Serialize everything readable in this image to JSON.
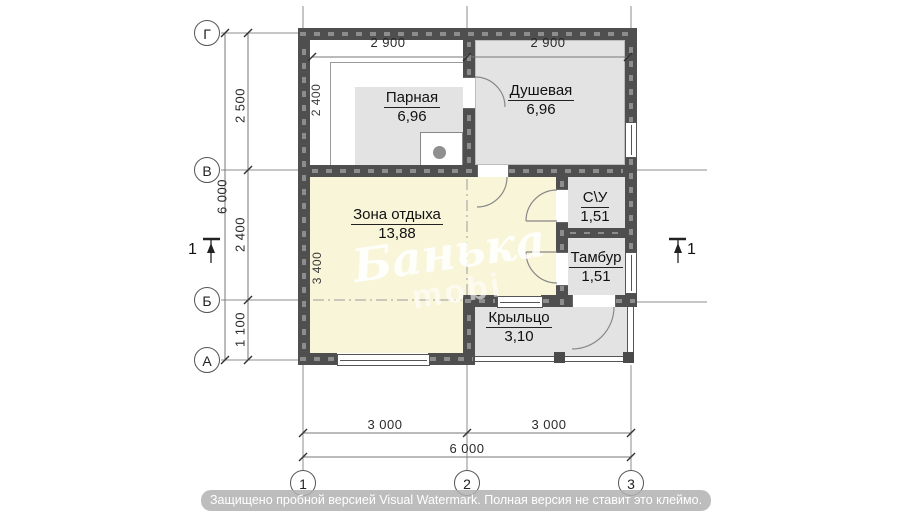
{
  "axes": {
    "rows": [
      "Г",
      "В",
      "Б",
      "А"
    ],
    "cols": [
      "1",
      "2",
      "3"
    ]
  },
  "rooms": [
    {
      "name": "Парная",
      "area": "6,96"
    },
    {
      "name": "Душевая",
      "area": "6,96"
    },
    {
      "name": "Зона отдыха",
      "area": "13,88"
    },
    {
      "name": "С\\У",
      "area": "1,51"
    },
    {
      "name": "Тамбур",
      "area": "1,51"
    },
    {
      "name": "Крыльцо",
      "area": "3,10"
    }
  ],
  "dimensions": {
    "top": [
      "2 900",
      "2 900"
    ],
    "left_total": "6 000",
    "left_segments": [
      "2 500",
      "2 400",
      "1 100"
    ],
    "inner": [
      "2 400",
      "3 400"
    ],
    "bottom_segments": [
      "3 000",
      "3 000"
    ],
    "bottom_total": "6 000"
  },
  "section": {
    "label": "1"
  },
  "watermark": {
    "script": "Банька",
    "sub": "mobi",
    "banner": "Защищено пробной версией Visual Watermark. Полная версия не ставит это клеймо."
  },
  "colors": {
    "wall": "#4f4f4f",
    "room_gray": "#e3e3e3",
    "room_yellow": "#f9f5d9"
  }
}
